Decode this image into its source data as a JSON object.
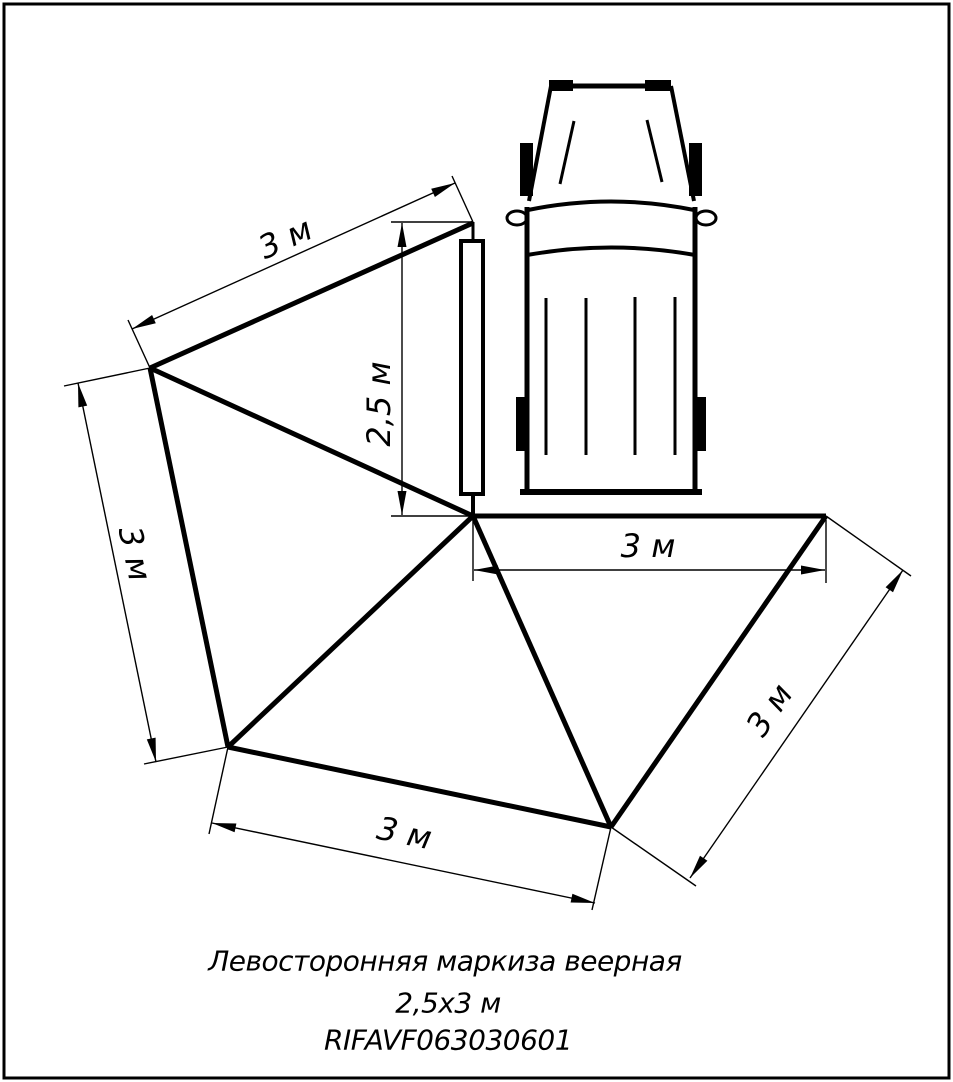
{
  "title": "Левосторонняя маркиза веерная 2,5х3 м",
  "caption": {
    "line1": "Левосторонняя маркиза веерная",
    "line2": "2,5х3 м",
    "line3": "RIFAVF063030601",
    "pos1": {
      "x": 445,
      "y": 961
    },
    "pos2": {
      "x": 448,
      "y": 1003
    },
    "pos3": {
      "x": 448,
      "y": 1040
    }
  },
  "colors": {
    "ink": "#000000",
    "paper": "#ffffff"
  },
  "dimensions_shown": [
    "3 м",
    "3 м",
    "3 м",
    "3 м",
    "3 м",
    "2,5 м"
  ],
  "drawing": {
    "width": 953,
    "height": 1082,
    "elements": [
      {
        "t": "rect",
        "n": "sheet-border",
        "k": "stroke",
        "a": {
          "x": 4,
          "y": 4,
          "width": 945,
          "height": 1074,
          "stroke-width": 3
        }
      },
      {
        "t": "line",
        "n": "vehicle-hood-top-edge",
        "k": "stroke",
        "a": {
          "x1": 551,
          "y1": 86,
          "x2": 671,
          "y2": 86,
          "stroke-width": 5
        }
      },
      {
        "t": "line",
        "n": "vehicle-hood-left-edge",
        "k": "stroke",
        "a": {
          "x1": 551,
          "y1": 86,
          "x2": 529,
          "y2": 201,
          "stroke-width": 4
        }
      },
      {
        "t": "line",
        "n": "vehicle-hood-right-edge",
        "k": "stroke",
        "a": {
          "x1": 671,
          "y1": 86,
          "x2": 694,
          "y2": 201,
          "stroke-width": 4
        }
      },
      {
        "t": "rect",
        "n": "vehicle-front-marker-left",
        "k": "fill",
        "a": {
          "x": 549,
          "y": 80,
          "width": 24,
          "height": 11
        }
      },
      {
        "t": "rect",
        "n": "vehicle-front-marker-right",
        "k": "fill",
        "a": {
          "x": 645,
          "y": 80,
          "width": 26,
          "height": 11
        }
      },
      {
        "t": "line",
        "n": "vehicle-wiper-left",
        "k": "stroke",
        "a": {
          "x1": 574,
          "y1": 121,
          "x2": 560,
          "y2": 184,
          "stroke-width": 3
        }
      },
      {
        "t": "line",
        "n": "vehicle-wiper-right",
        "k": "stroke",
        "a": {
          "x1": 647,
          "y1": 120,
          "x2": 662,
          "y2": 182,
          "stroke-width": 3
        }
      },
      {
        "t": "rect",
        "n": "vehicle-front-wheel-left",
        "k": "fill",
        "a": {
          "x": 520,
          "y": 143,
          "width": 13,
          "height": 53
        }
      },
      {
        "t": "rect",
        "n": "vehicle-front-wheel-right",
        "k": "fill",
        "a": {
          "x": 689,
          "y": 143,
          "width": 13,
          "height": 53
        }
      },
      {
        "t": "path",
        "n": "vehicle-windshield",
        "k": "stroke",
        "a": {
          "d": "M528,210 Q611,193 694,210",
          "stroke-width": 4
        }
      },
      {
        "t": "ellipse",
        "n": "vehicle-mirror-left",
        "k": "white",
        "a": {
          "cx": 517,
          "cy": 218,
          "rx": 10,
          "ry": 7,
          "stroke-width": 3
        }
      },
      {
        "t": "ellipse",
        "n": "vehicle-mirror-right",
        "k": "white",
        "a": {
          "cx": 706,
          "cy": 218,
          "rx": 10,
          "ry": 7,
          "stroke-width": 3
        }
      },
      {
        "t": "path",
        "n": "vehicle-cowl-line",
        "k": "stroke",
        "a": {
          "d": "M527,255 Q611,240 695,255",
          "stroke-width": 4
        }
      },
      {
        "t": "line",
        "n": "vehicle-body-left",
        "k": "stroke",
        "a": {
          "x1": 527,
          "y1": 207,
          "x2": 527,
          "y2": 492,
          "stroke-width": 5
        }
      },
      {
        "t": "line",
        "n": "vehicle-body-right",
        "k": "stroke",
        "a": {
          "x1": 695,
          "y1": 207,
          "x2": 695,
          "y2": 492,
          "stroke-width": 5
        }
      },
      {
        "t": "line",
        "n": "vehicle-rear-bumper",
        "k": "stroke",
        "a": {
          "x1": 520,
          "y1": 492,
          "x2": 702,
          "y2": 492,
          "stroke-width": 6
        }
      },
      {
        "t": "line",
        "n": "vehicle-roof-rib-1",
        "k": "stroke",
        "a": {
          "x1": 546,
          "y1": 298,
          "x2": 546,
          "y2": 455,
          "stroke-width": 3
        }
      },
      {
        "t": "line",
        "n": "vehicle-roof-rib-2",
        "k": "stroke",
        "a": {
          "x1": 586,
          "y1": 298,
          "x2": 586,
          "y2": 455,
          "stroke-width": 3
        }
      },
      {
        "t": "line",
        "n": "vehicle-roof-rib-3",
        "k": "stroke",
        "a": {
          "x1": 635,
          "y1": 297,
          "x2": 635,
          "y2": 455,
          "stroke-width": 3
        }
      },
      {
        "t": "line",
        "n": "vehicle-roof-rib-4",
        "k": "stroke",
        "a": {
          "x1": 675,
          "y1": 297,
          "x2": 675,
          "y2": 455,
          "stroke-width": 3
        }
      },
      {
        "t": "rect",
        "n": "vehicle-rear-wheel-left",
        "k": "fill",
        "a": {
          "x": 516,
          "y": 397,
          "width": 12,
          "height": 54
        }
      },
      {
        "t": "rect",
        "n": "vehicle-rear-wheel-right",
        "k": "fill",
        "a": {
          "x": 694,
          "y": 397,
          "width": 12,
          "height": 54
        }
      },
      {
        "t": "rect",
        "n": "awning-rail",
        "k": "white",
        "a": {
          "x": 461,
          "y": 241,
          "width": 22,
          "height": 253,
          "stroke-width": 4
        }
      },
      {
        "t": "line",
        "n": "awning-rail-top-link",
        "k": "stroke",
        "a": {
          "x1": 473,
          "y1": 222,
          "x2": 473,
          "y2": 243,
          "stroke-width": 3
        }
      },
      {
        "t": "line",
        "n": "awning-rail-bottom-link",
        "k": "stroke",
        "a": {
          "x1": 473,
          "y1": 494,
          "x2": 473,
          "y2": 517,
          "stroke-width": 4
        }
      },
      {
        "t": "line",
        "n": "awning-edge-apex-upperleft",
        "k": "stroke",
        "a": {
          "x1": 473,
          "y1": 223,
          "x2": 150,
          "y2": 368,
          "stroke-width": 5
        }
      },
      {
        "t": "line",
        "n": "awning-rib-upperleft-pivot",
        "k": "stroke",
        "a": {
          "x1": 150,
          "y1": 368,
          "x2": 473,
          "y2": 516,
          "stroke-width": 5
        }
      },
      {
        "t": "line",
        "n": "awning-edge-upperleft-left",
        "k": "stroke",
        "a": {
          "x1": 150,
          "y1": 368,
          "x2": 228,
          "y2": 747,
          "stroke-width": 5
        }
      },
      {
        "t": "line",
        "n": "awning-rib-left-pivot",
        "k": "stroke",
        "a": {
          "x1": 228,
          "y1": 747,
          "x2": 473,
          "y2": 516,
          "stroke-width": 5
        }
      },
      {
        "t": "line",
        "n": "awning-edge-left-bottom",
        "k": "stroke",
        "a": {
          "x1": 228,
          "y1": 747,
          "x2": 611,
          "y2": 827,
          "stroke-width": 5
        }
      },
      {
        "t": "line",
        "n": "awning-rib-bottom-pivot",
        "k": "stroke",
        "a": {
          "x1": 611,
          "y1": 827,
          "x2": 473,
          "y2": 516,
          "stroke-width": 5
        }
      },
      {
        "t": "line",
        "n": "awning-edge-bottom-right",
        "k": "stroke",
        "a": {
          "x1": 611,
          "y1": 827,
          "x2": 826,
          "y2": 516,
          "stroke-width": 5
        }
      },
      {
        "t": "line",
        "n": "awning-edge-pivot-right",
        "k": "stroke",
        "a": {
          "x1": 473,
          "y1": 516,
          "x2": 826,
          "y2": 516,
          "stroke-width": 5
        }
      },
      {
        "t": "line",
        "n": "dim-topleft-line",
        "k": "stroke",
        "a": {
          "x1": 132,
          "y1": 329,
          "x2": 455,
          "y2": 183,
          "stroke-width": 1.4
        }
      },
      {
        "t": "line",
        "n": "dim-topleft-ext-apex",
        "k": "stroke",
        "a": {
          "x1": 473,
          "y1": 222,
          "x2": 452,
          "y2": 176,
          "stroke-width": 1.4
        }
      },
      {
        "t": "line",
        "n": "dim-topleft-ext-vertex",
        "k": "stroke",
        "a": {
          "x1": 150,
          "y1": 368,
          "x2": 128,
          "y2": 320,
          "stroke-width": 1.4
        }
      },
      {
        "t": "line",
        "n": "dim-left-line",
        "k": "stroke",
        "a": {
          "x1": 78,
          "y1": 383,
          "x2": 156,
          "y2": 762,
          "stroke-width": 1.4
        }
      },
      {
        "t": "line",
        "n": "dim-left-ext-top",
        "k": "stroke",
        "a": {
          "x1": 150,
          "y1": 368,
          "x2": 64,
          "y2": 386,
          "stroke-width": 1.4
        }
      },
      {
        "t": "line",
        "n": "dim-left-ext-bottom",
        "k": "stroke",
        "a": {
          "x1": 228,
          "y1": 747,
          "x2": 144,
          "y2": 764,
          "stroke-width": 1.4
        }
      },
      {
        "t": "line",
        "n": "dim-bottom-line",
        "k": "stroke",
        "a": {
          "x1": 212,
          "y1": 823,
          "x2": 595,
          "y2": 903,
          "stroke-width": 1.4
        }
      },
      {
        "t": "line",
        "n": "dim-bottom-ext-left",
        "k": "stroke",
        "a": {
          "x1": 228,
          "y1": 747,
          "x2": 209,
          "y2": 834,
          "stroke-width": 1.4
        }
      },
      {
        "t": "line",
        "n": "dim-bottom-ext-right",
        "k": "stroke",
        "a": {
          "x1": 611,
          "y1": 827,
          "x2": 592,
          "y2": 910,
          "stroke-width": 1.4
        }
      },
      {
        "t": "line",
        "n": "dim-right-line",
        "k": "stroke",
        "a": {
          "x1": 903,
          "y1": 570,
          "x2": 690,
          "y2": 878,
          "stroke-width": 1.4
        }
      },
      {
        "t": "line",
        "n": "dim-right-ext-top",
        "k": "stroke",
        "a": {
          "x1": 826,
          "y1": 516,
          "x2": 911,
          "y2": 576,
          "stroke-width": 1.4
        }
      },
      {
        "t": "line",
        "n": "dim-right-ext-bottom",
        "k": "stroke",
        "a": {
          "x1": 611,
          "y1": 827,
          "x2": 696,
          "y2": 886,
          "stroke-width": 1.4
        }
      },
      {
        "t": "line",
        "n": "dim-horizontal-line",
        "k": "stroke",
        "a": {
          "x1": 474,
          "y1": 570,
          "x2": 825,
          "y2": 570,
          "stroke-width": 1.4
        }
      },
      {
        "t": "line",
        "n": "dim-horizontal-ext-left",
        "k": "stroke",
        "a": {
          "x1": 473,
          "y1": 520,
          "x2": 473,
          "y2": 581,
          "stroke-width": 1.4
        }
      },
      {
        "t": "line",
        "n": "dim-horizontal-ext-right",
        "k": "stroke",
        "a": {
          "x1": 826,
          "y1": 520,
          "x2": 826,
          "y2": 583,
          "stroke-width": 1.4
        }
      },
      {
        "t": "line",
        "n": "dim-vertical-line",
        "k": "stroke",
        "a": {
          "x1": 402,
          "y1": 223,
          "x2": 402,
          "y2": 515,
          "stroke-width": 1.4
        }
      },
      {
        "t": "line",
        "n": "dim-vertical-ext-top",
        "k": "stroke",
        "a": {
          "x1": 391,
          "y1": 222,
          "x2": 473,
          "y2": 222,
          "stroke-width": 1.4
        }
      },
      {
        "t": "line",
        "n": "dim-vertical-ext-bottom",
        "k": "stroke",
        "a": {
          "x1": 391,
          "y1": 516,
          "x2": 473,
          "y2": 516,
          "stroke-width": 1.4
        }
      },
      {
        "t": "polygon",
        "n": "arrowhead",
        "k": "fill",
        "a": {
          "points": "455,183 434.9,197 431.2,188.8"
        }
      },
      {
        "t": "polygon",
        "n": "arrowhead",
        "k": "fill",
        "a": {
          "points": "132,329 155.8,323.2 152.1,315"
        }
      },
      {
        "t": "polygon",
        "n": "arrowhead",
        "k": "fill",
        "a": {
          "points": "78,383 78.4,407.4 87.2,405.6"
        }
      },
      {
        "t": "polygon",
        "n": "arrowhead",
        "k": "fill",
        "a": {
          "points": "156,762 146.8,739.4 155.6,737.6"
        }
      },
      {
        "t": "polygon",
        "n": "arrowhead",
        "k": "fill",
        "a": {
          "points": "212,823 234.6,832.3 236.4,823.5"
        }
      },
      {
        "t": "polygon",
        "n": "arrowhead",
        "k": "fill",
        "a": {
          "points": "595,903 570.6,902.5 572.4,893.7"
        }
      },
      {
        "t": "polygon",
        "n": "arrowhead",
        "k": "fill",
        "a": {
          "points": "903,570 885.6,587.2 893,592.3"
        }
      },
      {
        "t": "polygon",
        "n": "arrowhead",
        "k": "fill",
        "a": {
          "points": "690,878 700,855.7 707.4,860.8"
        }
      },
      {
        "t": "polygon",
        "n": "arrowhead",
        "k": "fill",
        "a": {
          "points": "474,570 498,574.5 498,565.5"
        }
      },
      {
        "t": "polygon",
        "n": "arrowhead",
        "k": "fill",
        "a": {
          "points": "825,570 801,574.5 801,565.5"
        }
      },
      {
        "t": "polygon",
        "n": "arrowhead",
        "k": "fill",
        "a": {
          "points": "402,223 397.5,247 406.5,247"
        }
      },
      {
        "t": "polygon",
        "n": "arrowhead",
        "k": "fill",
        "a": {
          "points": "402,515 397.5,491 406.5,491"
        }
      },
      {
        "t": "text",
        "n": "dim-label-topleft",
        "k": "text",
        "text": "3 м",
        "a": {
          "transform": "translate(286,240) rotate(-24.5)",
          "font-size": "32"
        }
      },
      {
        "t": "text",
        "n": "dim-label-left",
        "k": "text",
        "text": "3 м",
        "a": {
          "transform": "translate(133,554) rotate(78)",
          "font-size": "32"
        }
      },
      {
        "t": "text",
        "n": "dim-label-bottom",
        "k": "text",
        "text": "3 м",
        "a": {
          "transform": "translate(404,835) rotate(11.5)",
          "font-size": "32"
        }
      },
      {
        "t": "text",
        "n": "dim-label-right",
        "k": "text",
        "text": "3 м",
        "a": {
          "transform": "translate(771,711) rotate(-55.5)",
          "font-size": "32"
        }
      },
      {
        "t": "text",
        "n": "dim-label-horizontal",
        "k": "text",
        "text": "3 м",
        "a": {
          "transform": "translate(648,548)",
          "font-size": "32"
        }
      },
      {
        "t": "text",
        "n": "dim-label-vertical",
        "k": "text",
        "text": "2,5 м",
        "a": {
          "transform": "translate(381,404) rotate(-90)",
          "font-size": "32"
        }
      }
    ]
  }
}
